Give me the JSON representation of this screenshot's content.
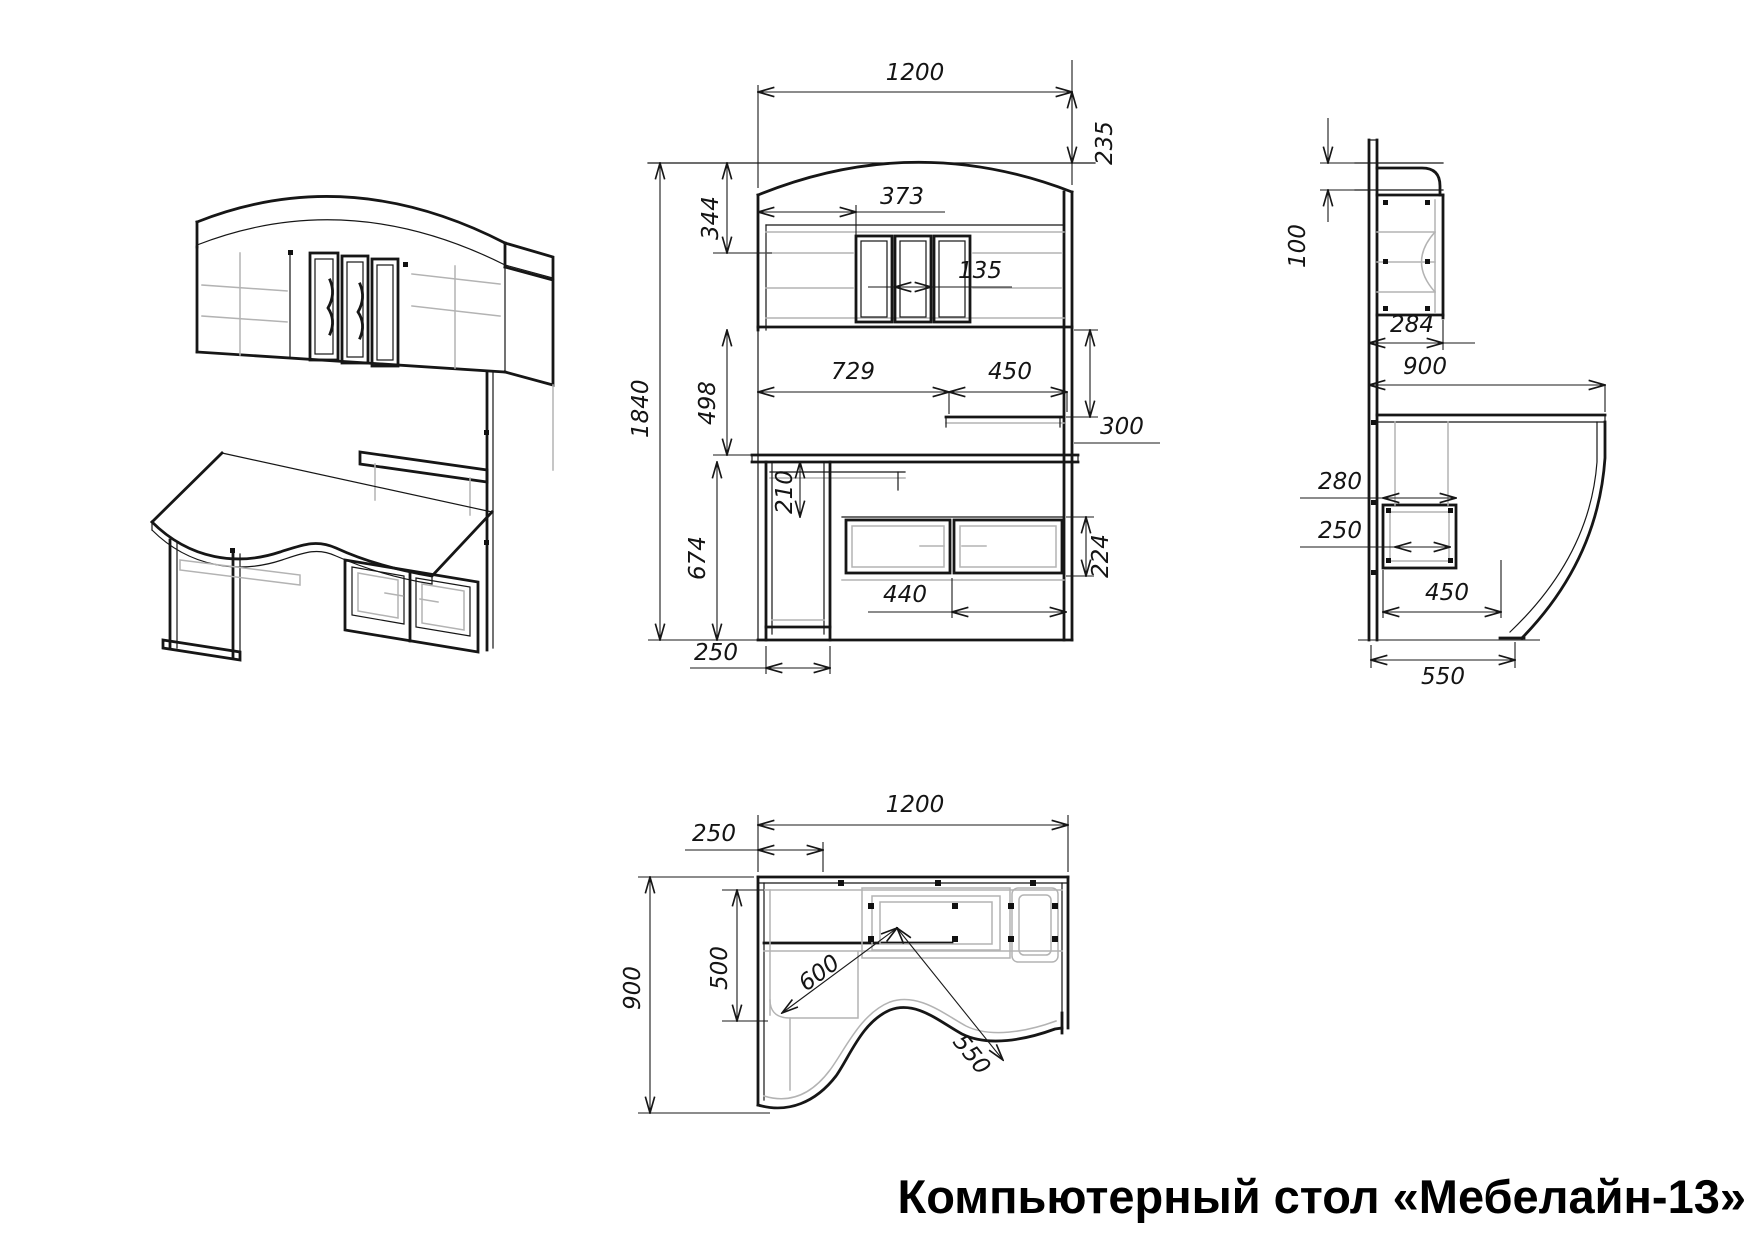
{
  "title": "Компьютерный стол «Мебелайн-13»",
  "dims": {
    "front": {
      "width": "1200",
      "crown_height": "235",
      "top_offset": "344",
      "shelf_span": "373",
      "door_width": "135",
      "total_height": "1840",
      "hutch_height": "498",
      "desk_span_left": "729",
      "desk_span_right": "450",
      "shelf_drop": "300",
      "tray_drop": "210",
      "underdesk_height": "674",
      "drawer_height": "224",
      "drawer_span": "440",
      "pedestal_width": "250"
    },
    "side": {
      "top_offset": "100",
      "hutch_depth": "284",
      "desk_depth": "900",
      "box_width": "280",
      "box_inner": "250",
      "shelf_span": "450",
      "base_depth": "550"
    },
    "top": {
      "width": "1200",
      "side_offset": "250",
      "depth": "900",
      "side_panel_depth": "500",
      "radius_left": "600",
      "radius_right": "550"
    }
  }
}
